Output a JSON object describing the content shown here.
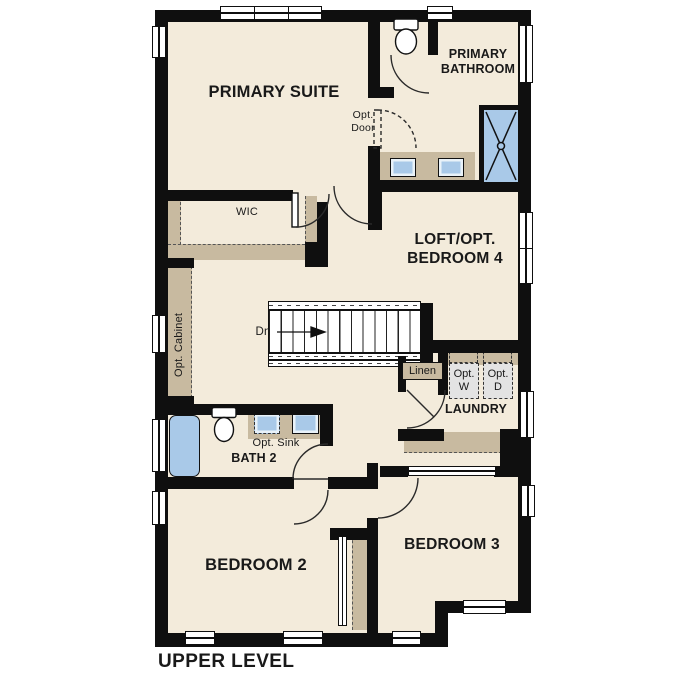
{
  "title": "UPPER LEVEL",
  "colors": {
    "background": "#ffffff",
    "wall": "#0f0f0f",
    "floor": "#f3ebdb",
    "cabinet_tan": "#c8baa0",
    "fixture_blue": "#a9c9e8",
    "appliance_gray": "#e3e3e3",
    "text": "#191919"
  },
  "rooms": {
    "primary_suite": "PRIMARY SUITE",
    "primary_bathroom": "PRIMARY BATHROOM",
    "wic": "WIC",
    "loft_bedroom4": "LOFT/OPT. BEDROOM 4",
    "laundry": "LAUNDRY",
    "bath_2": "BATH 2",
    "bedroom_2": "BEDROOM 2",
    "bedroom_3": "BEDROOM 3"
  },
  "annotations": {
    "opt_door": "Opt. Door",
    "opt_cabinet": "Opt. Cabinet",
    "opt_sink": "Opt. Sink",
    "linen": "Linen",
    "opt_washer": "Opt. W",
    "opt_dryer": "Opt. D",
    "stairs_down": "Dn"
  }
}
